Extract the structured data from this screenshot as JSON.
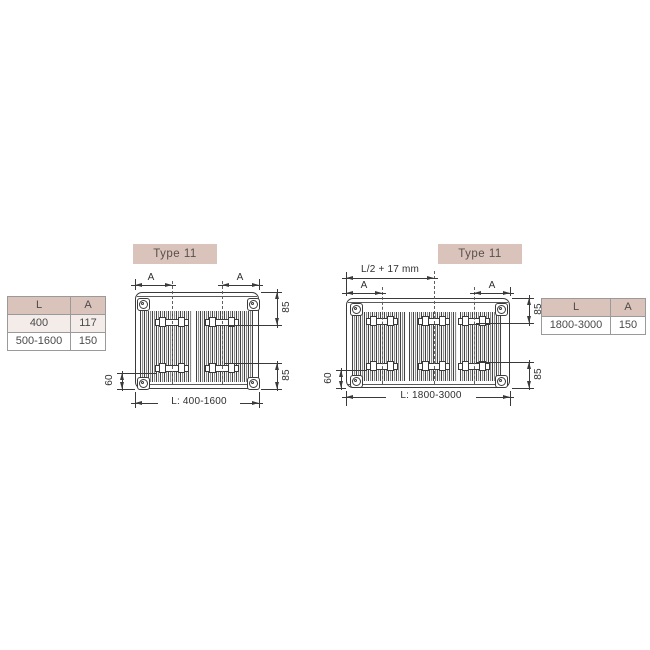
{
  "colors": {
    "accent_pink": "#d9c3bb",
    "row_pink": "#f4ece9",
    "line": "#3a3a3a",
    "table_border": "#9a9a9a"
  },
  "left_label": {
    "text": "Type 11"
  },
  "right_label": {
    "text": "Type 11"
  },
  "left_table": {
    "headers": [
      "L",
      "A"
    ],
    "rows": [
      [
        "400",
        "117"
      ],
      [
        "500-1600",
        "150"
      ]
    ]
  },
  "right_table": {
    "headers": [
      "L",
      "A"
    ],
    "rows": [
      [
        "1800-3000",
        "150"
      ]
    ]
  },
  "left_drawing": {
    "dim_a_left": "A",
    "dim_a_right": "A",
    "dim_85_top": "85",
    "dim_85_bottom": "85",
    "dim_60": "60",
    "dim_length": "L: 400-1600"
  },
  "right_drawing": {
    "dim_center_bracket": "L/2 + 17 mm",
    "dim_a_left": "A",
    "dim_a_right": "A",
    "dim_85_top": "85",
    "dim_85_bottom": "85",
    "dim_60": "60",
    "dim_length": "L: 1800-3000"
  }
}
